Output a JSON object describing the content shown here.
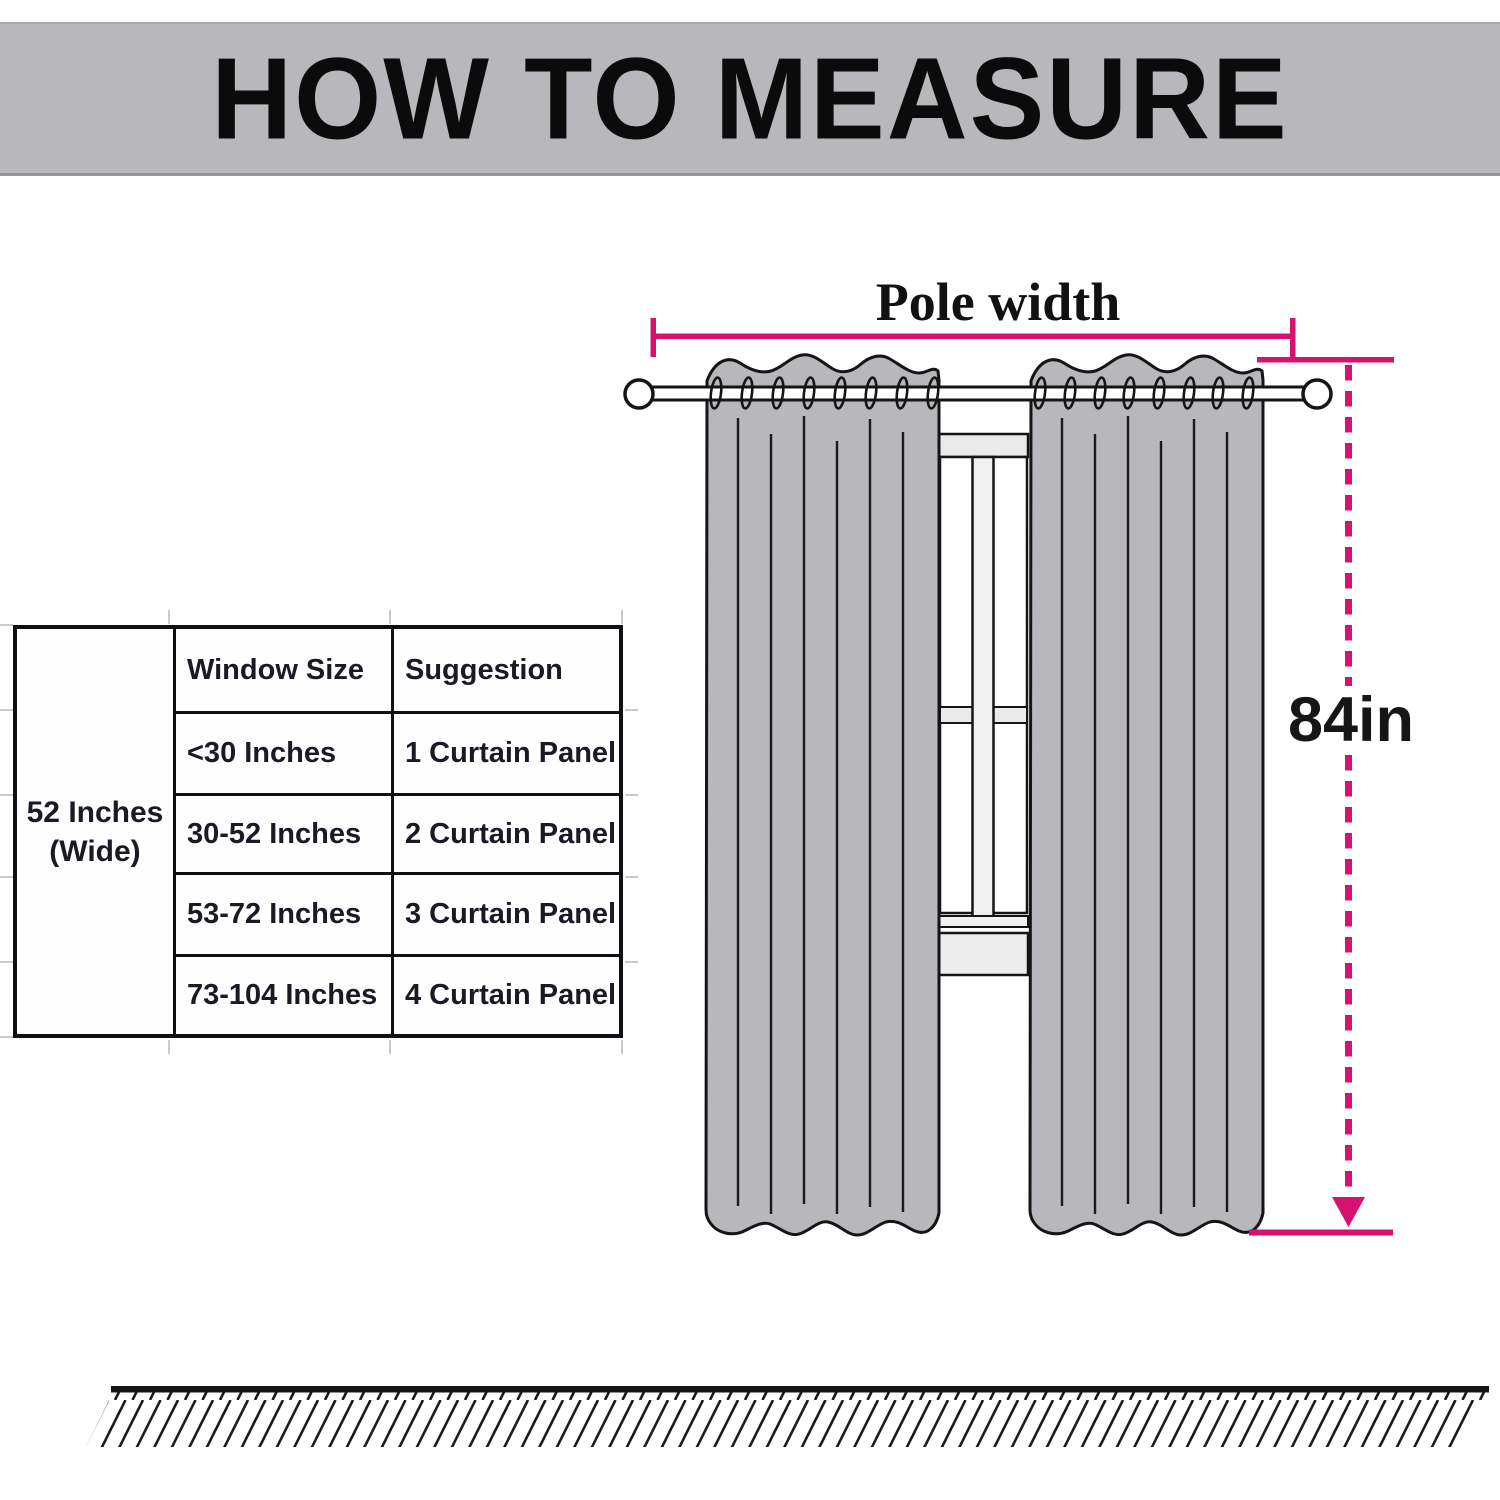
{
  "header": {
    "title": "HOW TO MEASURE"
  },
  "size_table": {
    "row_span_label": {
      "line1": "52 Inches",
      "line2": "(Wide)"
    },
    "columns": [
      "Window Size",
      "Suggestion"
    ],
    "rows": [
      {
        "window_size": "<30 Inches",
        "suggestion": "1 Curtain Panel"
      },
      {
        "window_size": "30-52 Inches",
        "suggestion": "2 Curtain Panel"
      },
      {
        "window_size": "53-72 Inches",
        "suggestion": "3 Curtain Panel"
      },
      {
        "window_size": "73-104 Inches",
        "suggestion": "4 Curtain Panel"
      }
    ]
  },
  "diagram": {
    "pole_width_label": "Pole width",
    "curtain_length_label": "84in",
    "panel_count": 2,
    "colors": {
      "measure_accent": "#d61270",
      "curtain_fill": "#b7b7bc",
      "banner_fill": "#b7b7bc",
      "window_frame_fill": "#ebebeb",
      "outline": "#151515"
    }
  }
}
